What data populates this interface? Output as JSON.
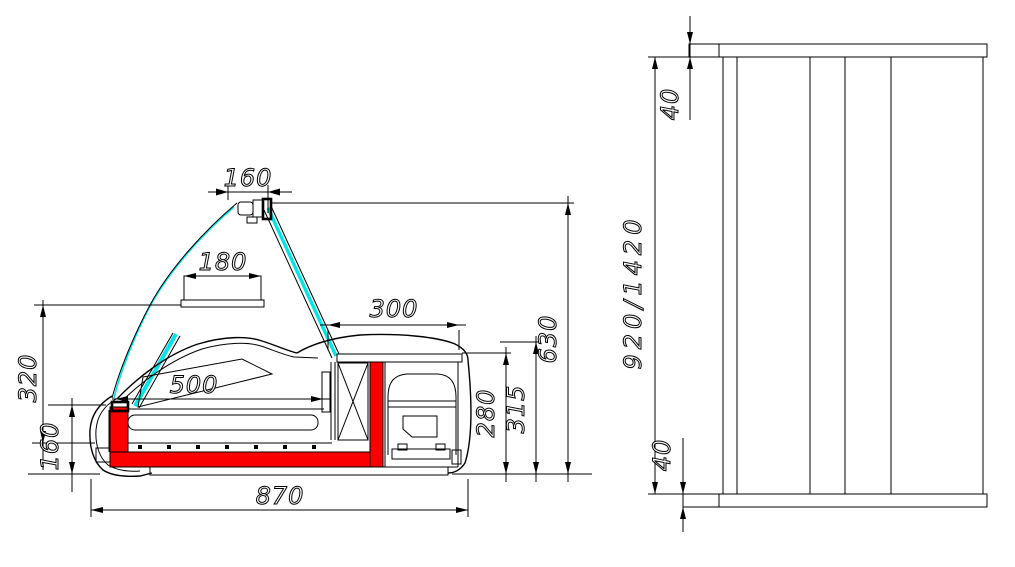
{
  "drawing_kind": "refrigerated counter display case - dimensioned technical drawing, side section and front view",
  "side": {
    "dims": {
      "lamp_width": "160",
      "canopy_width": "180",
      "machine_width": "300",
      "deck_length": "500",
      "glass_height": "320",
      "base_height": "160",
      "inner_height": "280",
      "compartment_height": "315",
      "overall_height": "630",
      "overall_depth": "870"
    }
  },
  "front": {
    "dims": {
      "top_thickness": "40",
      "body_height": "920/1420",
      "bottom_thickness": "40"
    }
  },
  "colors": {
    "line": "#000000",
    "glass": "#00e6e6",
    "insulation": "#fa0000",
    "background": "#ffffff"
  }
}
